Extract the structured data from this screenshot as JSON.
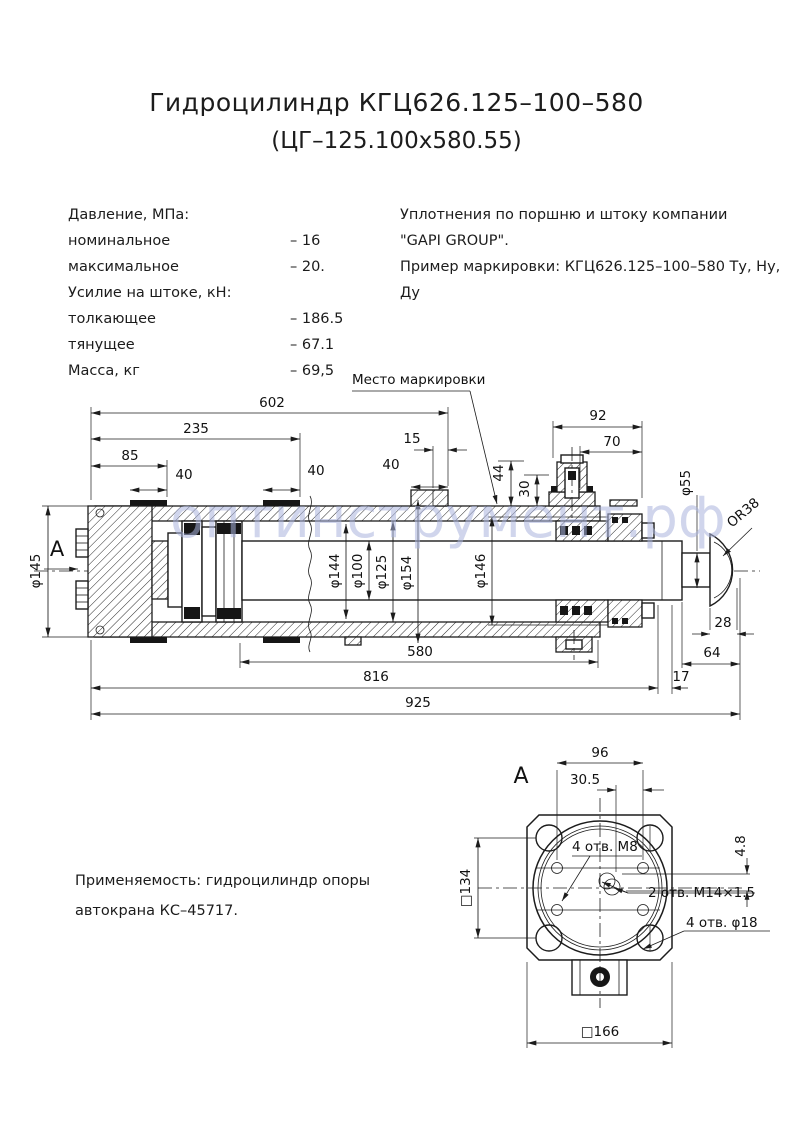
{
  "title": {
    "line1": "Гидроцилиндр КГЦ626.125–100–580",
    "line2": "(ЦГ–125.100х580.55)"
  },
  "specs": {
    "rows": [
      {
        "label": "Давление, МПа:",
        "value": ""
      },
      {
        "label": "номинальное",
        "value": "– 16"
      },
      {
        "label": "максимальное",
        "value": "– 20."
      },
      {
        "label": "Усилие на штоке, кН:",
        "value": ""
      },
      {
        "label": "толкающее",
        "value": "– 186.5"
      },
      {
        "label": "тянущее",
        "value": "– 67.1"
      },
      {
        "label": "Масса, кг",
        "value": "– 69,5"
      }
    ]
  },
  "seal_note": {
    "line1": "Уплотнения по поршню и штоку компании",
    "line2": "\"GAPI GROUP\".",
    "line3": "Пример маркировки: КГЦ626.125–100–580 Ту, Ну, Ду"
  },
  "application": {
    "line1": "Применяемость: гидроцилиндр опоры",
    "line2": "автокрана КС–45717."
  },
  "watermark": "оптинструмент.рф",
  "colors": {
    "line": "#1c1c1c",
    "watermark": "#aab4de"
  },
  "main_view": {
    "marking_label": "Место маркировки",
    "view_arrow_label": "А",
    "dims": {
      "d602": "602",
      "d235": "235",
      "d85": "85",
      "d40": "40",
      "d15": "15",
      "d44": "44",
      "d30": "30",
      "d92": "92",
      "d70": "70",
      "d145": "φ145",
      "d144": "φ144",
      "d100": "φ100",
      "d125": "φ125",
      "d154": "φ154",
      "d146": "φ146",
      "d55": "φ55",
      "r38": "OR38",
      "d28": "28",
      "d64": "64",
      "d580": "580",
      "d816": "816",
      "d17": "17",
      "d925": "925"
    }
  },
  "view_a": {
    "label": "А",
    "dims": {
      "d96": "96",
      "d305": "30.5",
      "d48": "4.8",
      "s134": "□134",
      "s166": "□166"
    },
    "notes": {
      "m8": "4 отв. М8",
      "m14": "2 отв. М14×1.5",
      "d18": "4 отв. φ18"
    }
  }
}
